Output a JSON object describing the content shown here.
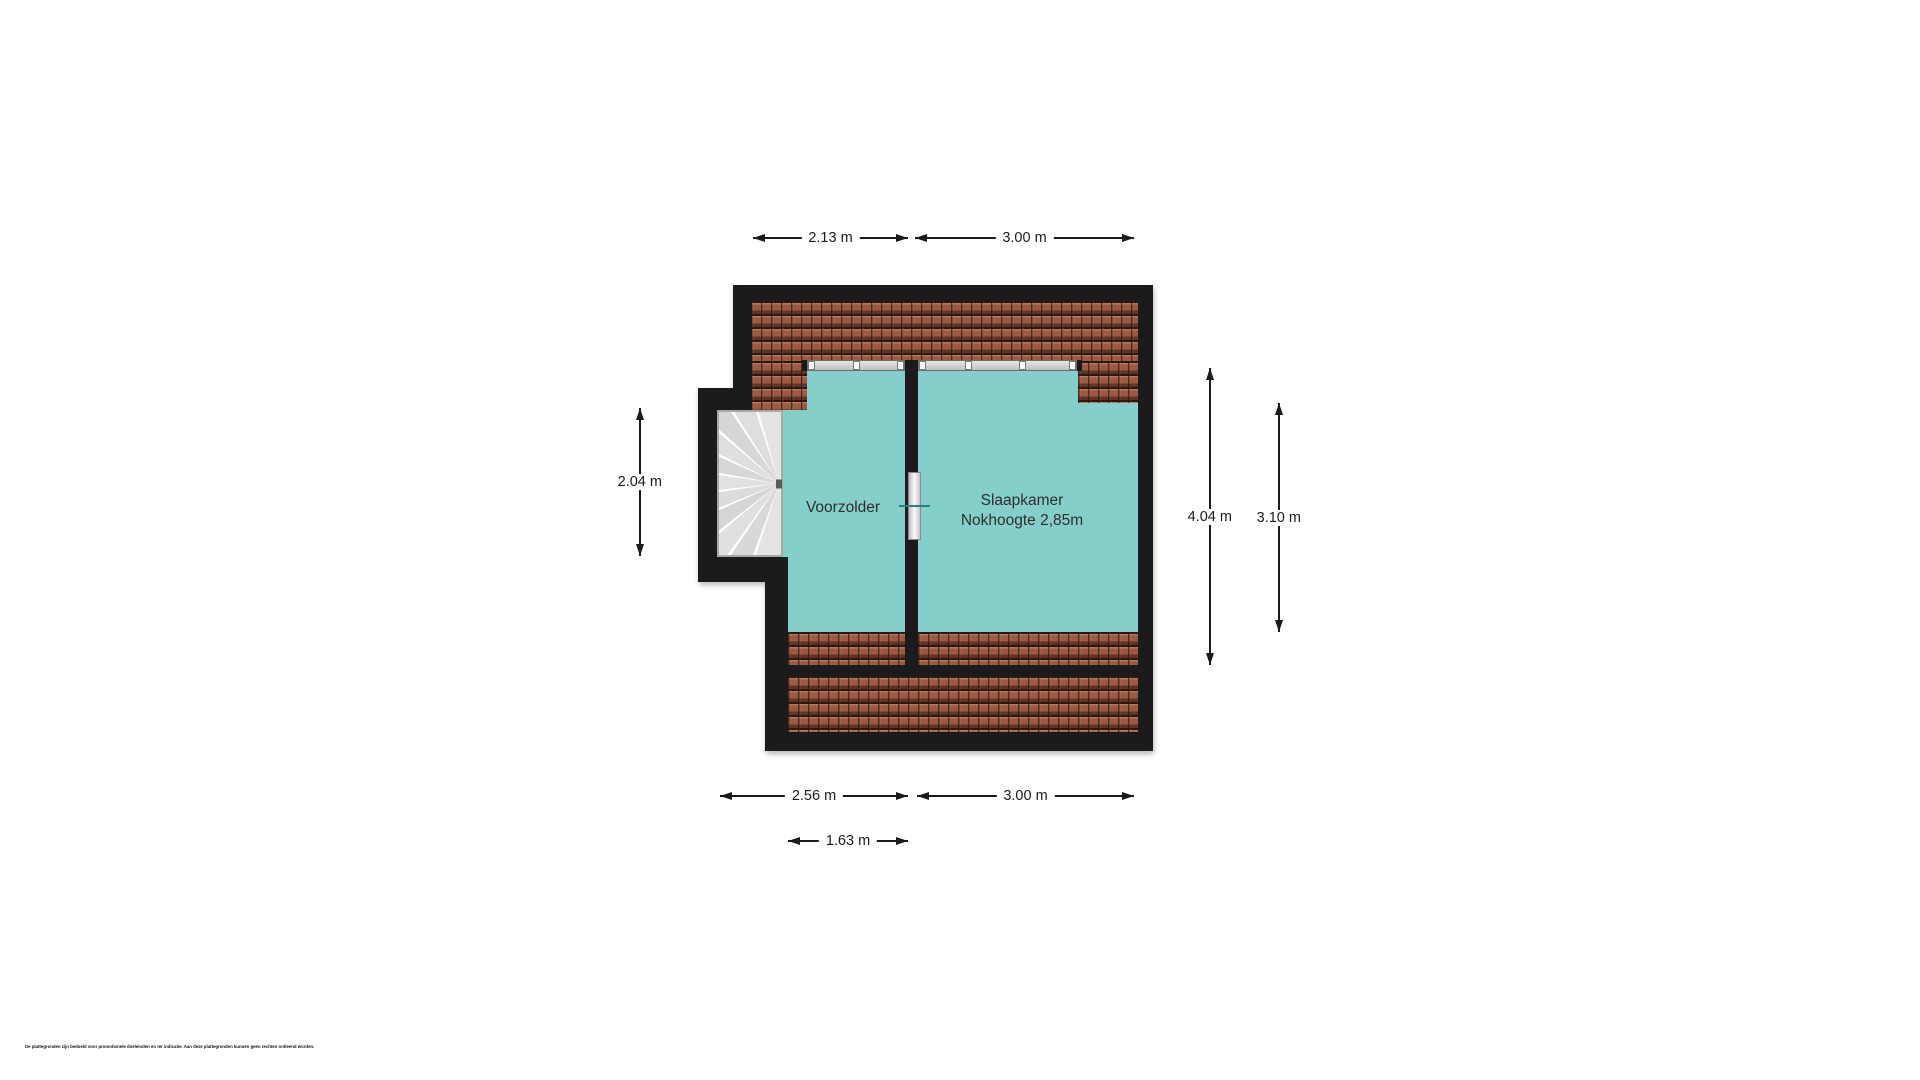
{
  "floorplan": {
    "rooms": {
      "voorzolder": {
        "name": "Voorzolder"
      },
      "slaapkamer": {
        "name": "Slaapkamer",
        "note": "Nokhoogte 2,85m"
      }
    },
    "dimensions": {
      "top_left": "2.13 m",
      "top_right": "3.00 m",
      "left": "2.04 m",
      "right_outer": "4.04 m",
      "right_inner": "3.10 m",
      "bottom_left": "2.56 m",
      "bottom_right": "3.00 m",
      "bottom_inner": "1.63 m"
    },
    "colors": {
      "floor": "#85cfca",
      "roof": "#9b5a41",
      "wall": "#1b1b1b",
      "dim": "#1b1b1b"
    },
    "disclaimer": "De plattegronden zijn bedoeld voor promotionele doeleinden en ter indicatie. Aan deze plattegronden kunnen geen rechten ontleend worden."
  }
}
